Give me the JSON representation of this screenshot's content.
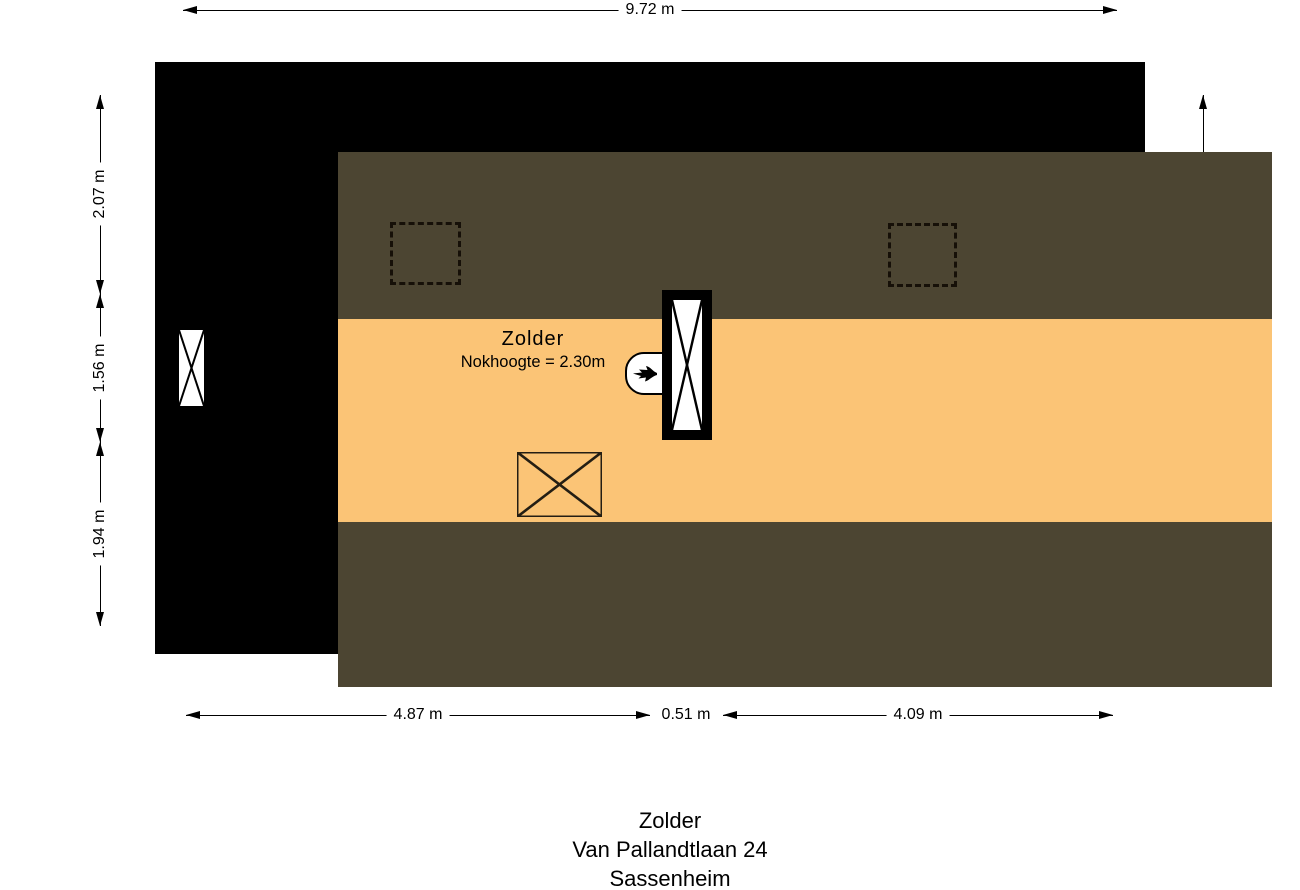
{
  "plan": {
    "room_label": "Zolder",
    "ridge_height_label": "Nokhoogte = 2.30m"
  },
  "dimensions": {
    "top_width": "9.72 m",
    "left_segments": [
      {
        "label": "2.07 m"
      },
      {
        "label": "1.56 m"
      },
      {
        "label": "1.94 m"
      }
    ],
    "right_inner_height": "2.10 m",
    "right_total_height": "5.56 m",
    "bottom_segments": [
      {
        "label": "4.87 m"
      },
      {
        "label": "0.51 m"
      },
      {
        "label": "4.09 m"
      }
    ]
  },
  "caption": {
    "floor": "Zolder",
    "address": "Van Pallandtlaan 24",
    "city": "Sassenheim"
  },
  "colors": {
    "wall": "#000000",
    "floor_area": "#fbc476",
    "sloped_ceiling_area": "#4c4532",
    "dimension_line": "#000000"
  },
  "icons": {
    "boiler": "flame-icon",
    "window": "window-cross-icon",
    "shaft": "shaft-cross-icon",
    "stairs": "stair-opening-cross-icon",
    "roof_window": "roof-window-dashed-outline"
  }
}
